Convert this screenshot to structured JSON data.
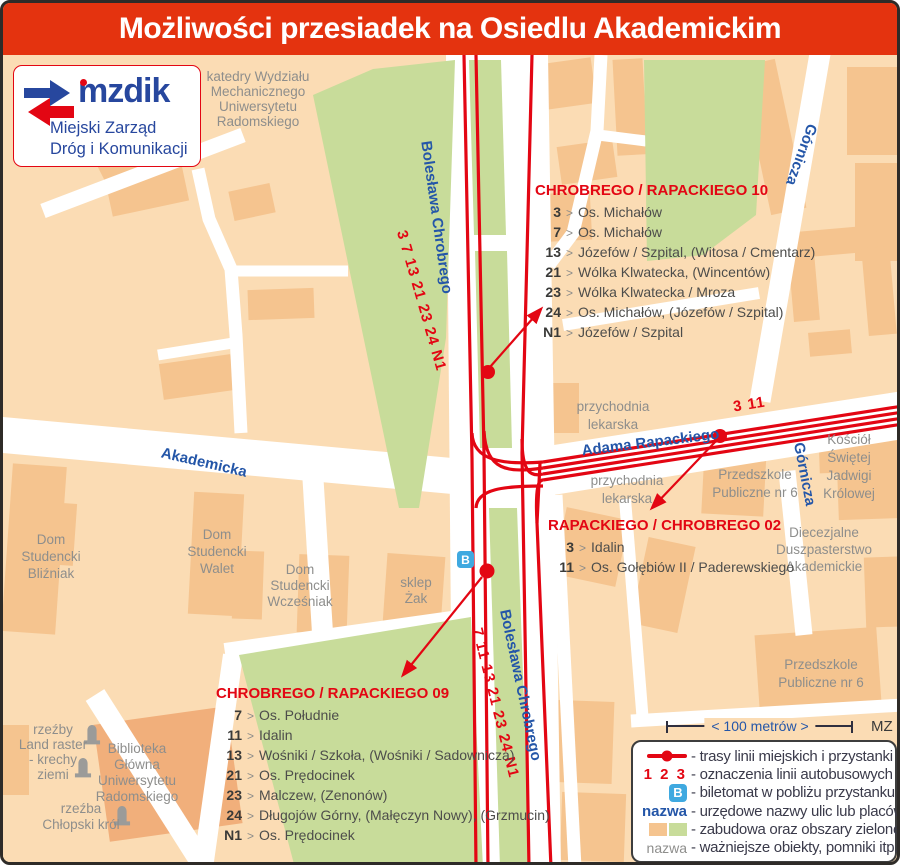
{
  "title": "Możliwości przesiadek na Osiedlu Akademickim",
  "logo": {
    "brand": "mzdik",
    "line1": "Miejski Zarząd",
    "line2": "Dróg i Komunikacji"
  },
  "sep": ">",
  "map": {
    "streets": {
      "chrobrego_top": "Bolesława Chrobrego",
      "chrobrego_bottom": "Bolesława Chrobrego",
      "akademicka": "Akademicka",
      "rapackiego": "Adama Rapackiego",
      "gornicza_top": "Górnicza",
      "gornicza_south": "Górnicza"
    },
    "route_labels": {
      "chrobrego_north": "3 7 13 21 23 24 N1",
      "chrobrego_south": "7 11 13 21 23 24 N1",
      "rapackiego_east": "3 11"
    },
    "ticket_machine_label": "B",
    "places": {
      "katedry": [
        "katedry Wydziału",
        "Mechanicznego",
        "Uniwersytetu",
        "Radomskiego"
      ],
      "przychodnia1": [
        "przychodnia",
        "lekarska"
      ],
      "przychodnia2": [
        "przychodnia",
        "lekarska"
      ],
      "przedszkole1": [
        "Przedszkole",
        "Publiczne nr 6"
      ],
      "przedszkole2": [
        "Przedszkole",
        "Publiczne nr 6"
      ],
      "kosciol": [
        "Kościół",
        "Świętej",
        "Jadwigi",
        "Królowej"
      ],
      "duszpasterstwo": [
        "Diecezjalne",
        "Duszpasterstwo",
        "Akademickie"
      ],
      "dom_blizniak": [
        "Dom",
        "Studencki",
        "Bliźniak"
      ],
      "dom_walet": [
        "Dom",
        "Studencki",
        "Walet"
      ],
      "dom_wczesniak": [
        "Dom",
        "Studencki",
        "Wcześniak"
      ],
      "sklep_zak": [
        "sklep",
        "Żak"
      ],
      "biblioteka": [
        "Biblioteka",
        "Główna",
        "Uniwersytetu",
        "Radomskiego"
      ],
      "rzezby_land": [
        "rzeźby",
        "Land raster",
        "- krechy",
        "ziemi"
      ],
      "rzezba_krol": [
        "rzeźba",
        "Chłopski król"
      ]
    }
  },
  "stops": [
    {
      "name": "CHROBREGO / RAPACKIEGO 10",
      "lines": [
        {
          "no": "3",
          "dest": "Os. Michałów"
        },
        {
          "no": "7",
          "dest": "Os. Michałów"
        },
        {
          "no": "13",
          "dest": "Józefów / Szpital, (Witosa / Cmentarz)"
        },
        {
          "no": "21",
          "dest": "Wólka Klwatecka, (Wincentów)"
        },
        {
          "no": "23",
          "dest": "Wólka Klwatecka / Mroza"
        },
        {
          "no": "24",
          "dest": "Os. Michałów, (Józefów / Szpital)"
        },
        {
          "no": "N1",
          "dest": "Józefów / Szpital"
        }
      ]
    },
    {
      "name": "RAPACKIEGO / CHROBREGO 02",
      "lines": [
        {
          "no": "3",
          "dest": "Idalin"
        },
        {
          "no": "11",
          "dest": "Os. Gołębiów II / Paderewskiego"
        }
      ]
    },
    {
      "name": "CHROBREGO / RAPACKIEGO 09",
      "lines": [
        {
          "no": "7",
          "dest": "Os. Południe"
        },
        {
          "no": "11",
          "dest": "Idalin"
        },
        {
          "no": "13",
          "dest": "Wośniki / Szkoła, (Wośniki / Sadownicza)"
        },
        {
          "no": "21",
          "dest": "Os. Prędocinek"
        },
        {
          "no": "23",
          "dest": "Malczew, (Zenonów)"
        },
        {
          "no": "24",
          "dest": "Długojów Górny, (Małęczyn Nowy), (Grzmucin)"
        },
        {
          "no": "N1",
          "dest": "Os. Prędocinek"
        }
      ]
    }
  ],
  "legend": {
    "scale_label": "< 100 metrów >",
    "credit": "MZ",
    "items": [
      {
        "icon": "route-stop",
        "label": "- trasy linii miejskich i przystanki"
      },
      {
        "icon": "line-numbers",
        "icon_text": "1 2 3",
        "label": "- oznaczenia linii autobusowych"
      },
      {
        "icon": "ticket-machine",
        "icon_text": "B",
        "label": "- biletomat w pobliżu przystanku"
      },
      {
        "icon": "street-name",
        "icon_text": "nazwa",
        "label": "- urzędowe nazwy ulic lub placów"
      },
      {
        "icon": "area-swatches",
        "label": "- zabudowa oraz obszary zielone"
      },
      {
        "icon": "object-name",
        "icon_text": "nazwa",
        "label": "- ważniejsze obiekty, pomniki itp."
      }
    ]
  },
  "colors": {
    "title_bg": "#E4330F",
    "route_red": "#E30613",
    "street_blue": "#2456A8",
    "background": "#FBDCB4",
    "building": "#F5C48F",
    "green": "#C8DC9A",
    "ticket_blue": "#3FA9E0",
    "object_gray": "#8E8E8C"
  }
}
